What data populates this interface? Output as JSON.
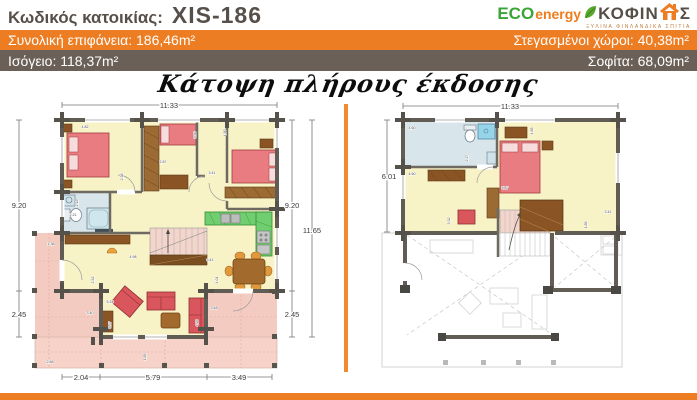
{
  "header": {
    "label": "Κωδικός κατοικίας:",
    "code": "XIS-186"
  },
  "logo": {
    "eco": "ECO",
    "energy": "energy",
    "brand_left": "ΚΟΦΙΝ",
    "brand_right": "Σ",
    "tagline": "ΞΥΛΙΝΑ ΦΙΝΛΑΝΔΙΚΑ ΣΠΙΤΙΑ"
  },
  "stats": {
    "total": "Συνολική επιφάνεια: 186,46m²",
    "covered": "Στεγασμένοι χώροι: 40,38m²",
    "ground": "Ισόγειο: 118,37m²",
    "attic": "Σοφίτα: 68,09m²"
  },
  "title": "Κάτοψη πλήρους έκδοσης",
  "ground_plan": {
    "name": "Ισόγειο (κάτοψη)",
    "dims": {
      "width_top": "11.33",
      "left_main": "9.20",
      "left_lower": "2.45",
      "right_main": "9.20",
      "right_lower": "2.45",
      "right_total": "11.65",
      "bottom_left": "2.04",
      "bottom_mid": "5.79",
      "bottom_right": "3.49"
    },
    "interior_dims": [
      {
        "t": "4.82",
        "x": 80,
        "y": 33
      },
      {
        "t": "2.38",
        "x": 118,
        "y": 82,
        "r": -90
      },
      {
        "t": "2.87",
        "x": 158,
        "y": 68
      },
      {
        "t": "3.36",
        "x": 191,
        "y": 40,
        "r": -90
      },
      {
        "t": "4.50",
        "x": 221,
        "y": 38,
        "r": -90
      },
      {
        "t": "3.41",
        "x": 207,
        "y": 79
      },
      {
        "t": "2.19",
        "x": 73,
        "y": 108,
        "r": -90
      },
      {
        "t": "2.21",
        "x": 68,
        "y": 121
      },
      {
        "t": "4.98",
        "x": 128,
        "y": 163
      },
      {
        "t": "3.41",
        "x": 205,
        "y": 166
      },
      {
        "t": "1.38",
        "x": 46,
        "y": 150
      },
      {
        "t": "2.52",
        "x": 89,
        "y": 185,
        "r": -90
      },
      {
        "t": "5.24",
        "x": 105,
        "y": 208
      },
      {
        "t": "3.40",
        "x": 85,
        "y": 219
      },
      {
        "t": "5.37",
        "x": 106,
        "y": 230,
        "r": -90
      },
      {
        "t": "4.28",
        "x": 193,
        "y": 228,
        "r": -90
      },
      {
        "t": "3.48",
        "x": 209,
        "y": 214
      },
      {
        "t": "4.01",
        "x": 213,
        "y": 185,
        "r": -90
      },
      {
        "t": "1.85",
        "x": 141,
        "y": 262,
        "r": -90
      },
      {
        "t": "2.68",
        "x": 45,
        "y": 268
      }
    ]
  },
  "attic_plan": {
    "name": "Σοφίτα (κάτοψη)",
    "dims": {
      "width_top": "11.33",
      "left": "6.01"
    },
    "interior_dims": [
      {
        "t": "4.60",
        "x": 47,
        "y": 34
      },
      {
        "t": "4.60",
        "x": 47,
        "y": 80
      },
      {
        "t": "2.27",
        "x": 103,
        "y": 63,
        "r": -90
      },
      {
        "t": "4.85",
        "x": 168,
        "y": 36,
        "r": -90
      },
      {
        "t": "5.87",
        "x": 140,
        "y": 94
      },
      {
        "t": "3.32",
        "x": 85,
        "y": 126,
        "r": -90
      },
      {
        "t": "3.41",
        "x": 243,
        "y": 118
      },
      {
        "t": "1.85",
        "x": 222,
        "y": 130,
        "r": -90
      }
    ]
  },
  "colors": {
    "accent_orange": "#ED7D23",
    "bar_brown": "#6B6058",
    "logo_green": "#3BA437",
    "header_text": "#57504A",
    "floor_yellow": "#F7F3C6",
    "bathroom_blue": "#D8E5EB",
    "shower_blue": "#96D4EA",
    "veranda_pink": "#F4CBC0",
    "stairs_pink": "#F3D5CC",
    "kitchen_green": "#70CD70",
    "bed_red": "#E97C80",
    "furniture_brown": "#8A5425",
    "wall_gray": "#63605A"
  }
}
